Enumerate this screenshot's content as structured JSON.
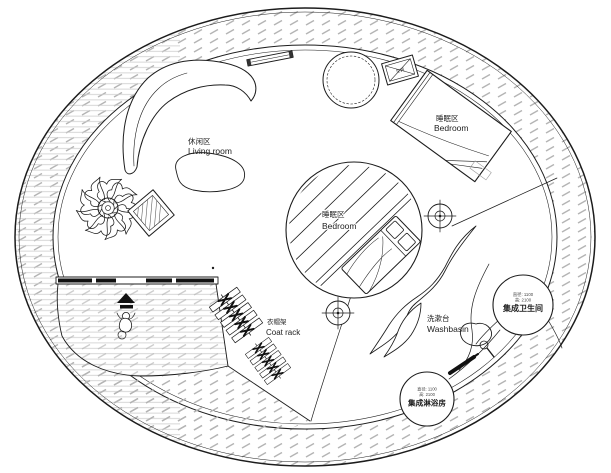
{
  "plan": {
    "zones": {
      "living_room": {
        "zh": "休闲区",
        "en": "Living room"
      },
      "bedroom_upper": {
        "zh": "睡眠区",
        "en": "Bedroom"
      },
      "bedroom_center": {
        "zh": "睡眠区",
        "en": "Bedroom"
      },
      "coat_rack": {
        "zh": "衣帽架",
        "en": "Coat rack"
      },
      "washbasin": {
        "zh": "洗漱台",
        "en": "Washbasin"
      }
    },
    "pods": {
      "bathroom": {
        "dim1": "直径: 1100",
        "dim2": "高: 2100",
        "name": "集成卫生间"
      },
      "shower": {
        "dim1": "直径: 1100",
        "dim2": "高: 2100",
        "name": "集成淋浴房"
      }
    },
    "equipment": {
      "ac_label": "空调"
    }
  },
  "colors": {
    "ink": "#1c1c1c",
    "hatch": "#b4b4b4",
    "paper": "#ffffff"
  }
}
